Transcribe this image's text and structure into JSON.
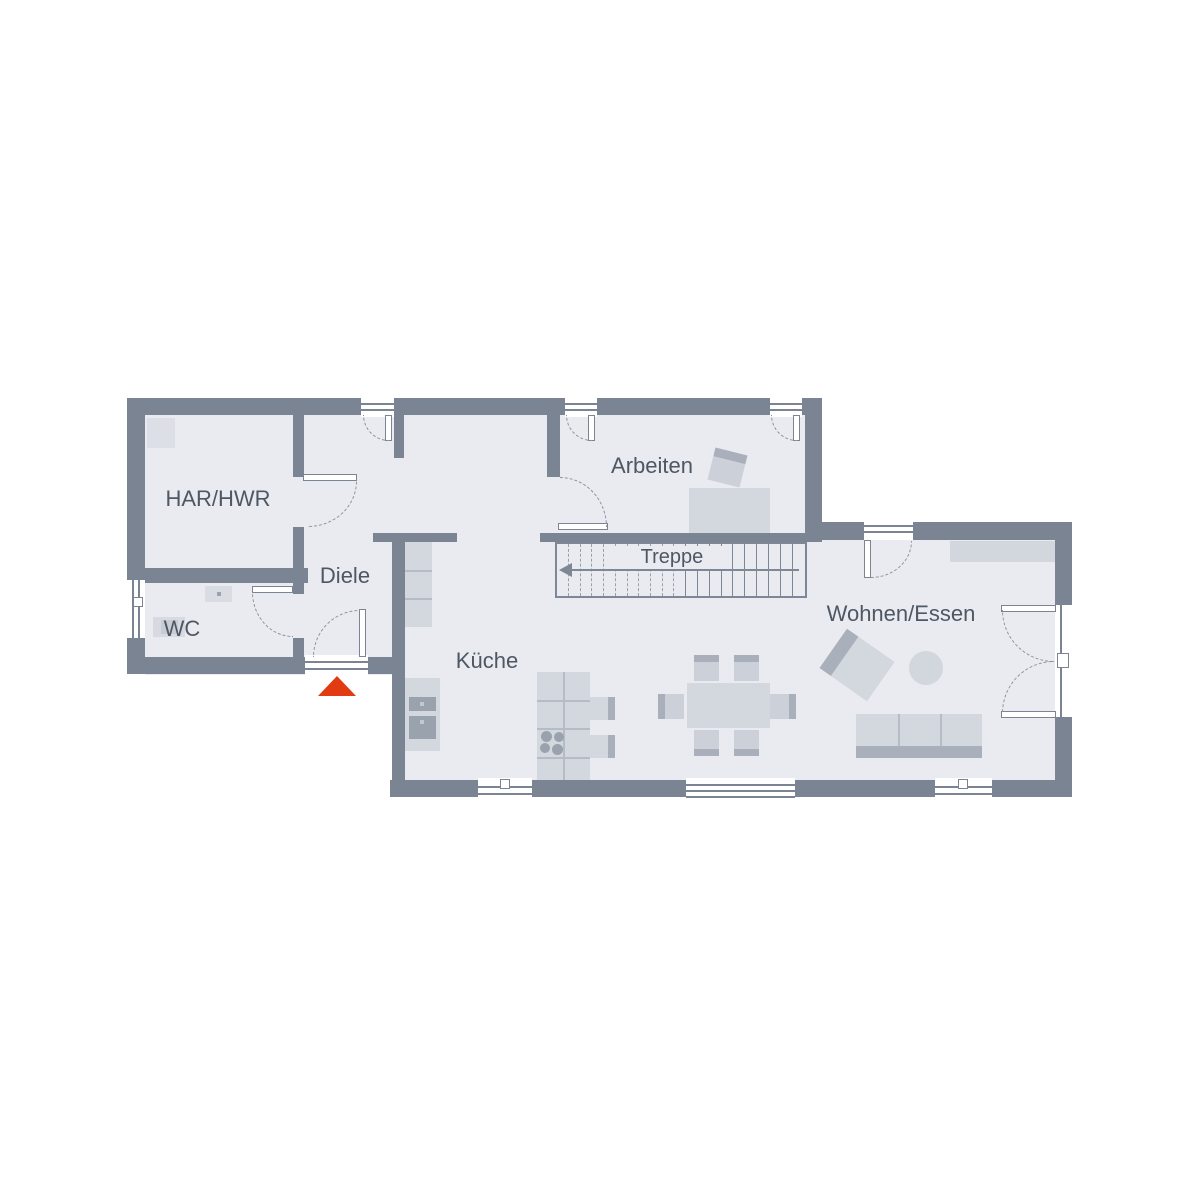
{
  "plan": {
    "title_type": "ground-floor-plan",
    "rooms": [
      {
        "id": "har-hwr",
        "label": "HAR/HWR"
      },
      {
        "id": "wc",
        "label": "WC"
      },
      {
        "id": "diele",
        "label": "Diele"
      },
      {
        "id": "arbeiten",
        "label": "Arbeiten"
      },
      {
        "id": "treppe",
        "label": "Treppe"
      },
      {
        "id": "kueche",
        "label": "Küche"
      },
      {
        "id": "wohnen-essen",
        "label": "Wohnen/Essen"
      }
    ],
    "colors": {
      "wall": "#7b8493",
      "floor": "#e9ebf0",
      "furniture": "#d3d7de",
      "furniture_accent": "#a9b0bc",
      "entrance_arrow": "#e23b12",
      "label_text": "#4e5763"
    },
    "icons": {
      "entrance_arrow": "entrance-direction-arrow",
      "stair_arrow": "stair-direction-arrow"
    }
  }
}
